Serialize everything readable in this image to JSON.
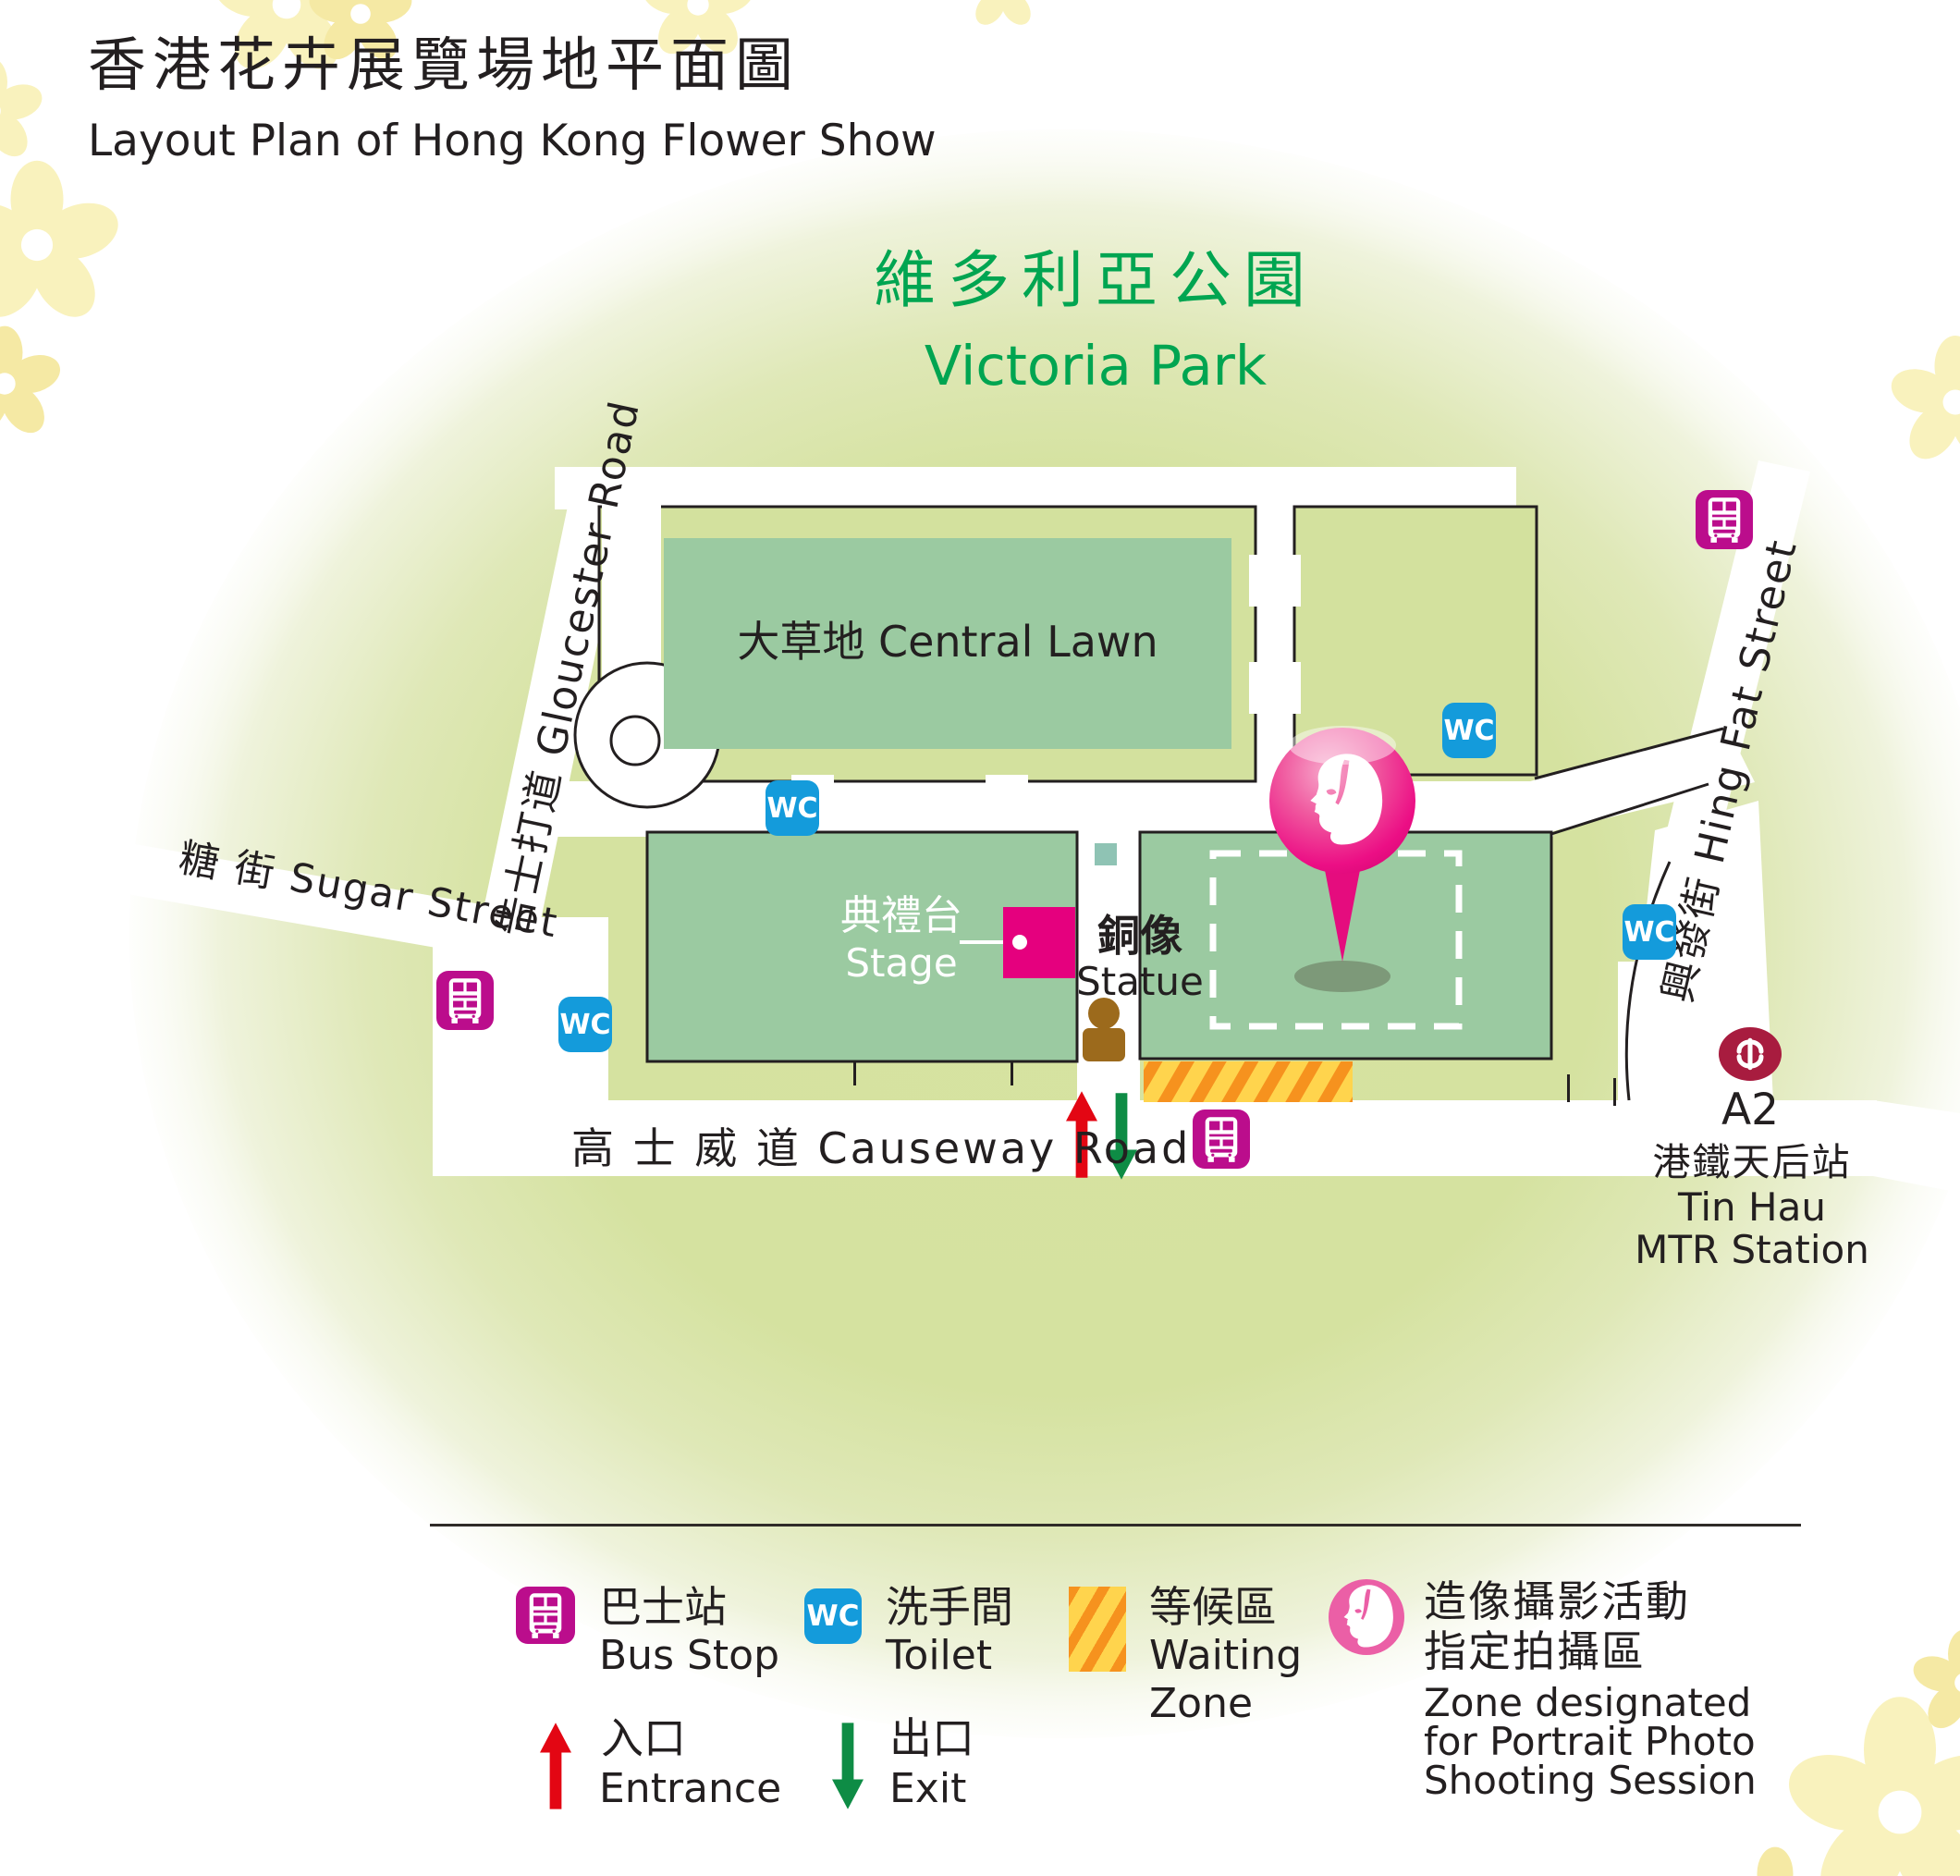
{
  "title": {
    "zh": "香港花卉展覽場地平面圖",
    "en": "Layout Plan of Hong Kong Flower Show"
  },
  "park": {
    "zh": "維多利亞公園",
    "en": "Victoria Park"
  },
  "areas": {
    "central_lawn": "大草地 Central Lawn",
    "stage_zh": "典禮台",
    "stage_en": "Stage",
    "statue_zh": "銅像",
    "statue_en": "Statue"
  },
  "roads": {
    "gloucester": "告士打道  Gloucester Road",
    "sugar": "糖 街 Sugar Street",
    "hing_fat": "興發街  Hing Fat Street",
    "causeway": "高 士 威 道  Causeway Road"
  },
  "mtr": {
    "exit": "A2",
    "station_zh": "港鐵天后站",
    "station_en_line1": "Tin Hau",
    "station_en_line2": "MTR Station"
  },
  "icons": {
    "wc_label": "WC",
    "bus_icon": "double-decker-bus",
    "mtr_icon": "mtr-logo",
    "photo_icon": "woman-portrait",
    "statue_icon": "person-statue",
    "pin_icon": "location-pin-portrait"
  },
  "legend": {
    "bus_zh": "巴士站",
    "bus_en": "Bus Stop",
    "toilet_zh": "洗手間",
    "toilet_en": "Toilet",
    "waiting_zh": "等候區",
    "waiting_en_line1": "Waiting",
    "waiting_en_line2": "Zone",
    "photo_zh_line1": "造像攝影活動",
    "photo_zh_line2": "指定拍攝區",
    "photo_en_line1": "Zone designated",
    "photo_en_line2": "for Portrait Photo",
    "photo_en_line3": "Shooting Session",
    "entrance_zh": "入口",
    "entrance_en": "Entrance",
    "exit_zh": "出口",
    "exit_en": "Exit"
  },
  "colors": {
    "park_text_green": "#00a551",
    "wash_green": "#d6e3a1",
    "lawn_green": "#9bcaa1",
    "block_green": "#d3e19e",
    "road_white": "#ffffff",
    "outline_black": "#231f20",
    "stage_pink": "#e5007e",
    "wc_blue": "#149bdb",
    "bus_magenta": "#bb0d8c",
    "mtr_red": "#a81c3f",
    "pin_pink": "#ec008c",
    "legend_photo_pink": "#eb5fa6",
    "waiting_yellow": "#ffd44d",
    "waiting_orange": "#f6921e",
    "entrance_red": "#e30613",
    "exit_green": "#0e8c45",
    "statue_brown": "#9c6a1c",
    "flower_yellow": "#f8f0ba"
  }
}
